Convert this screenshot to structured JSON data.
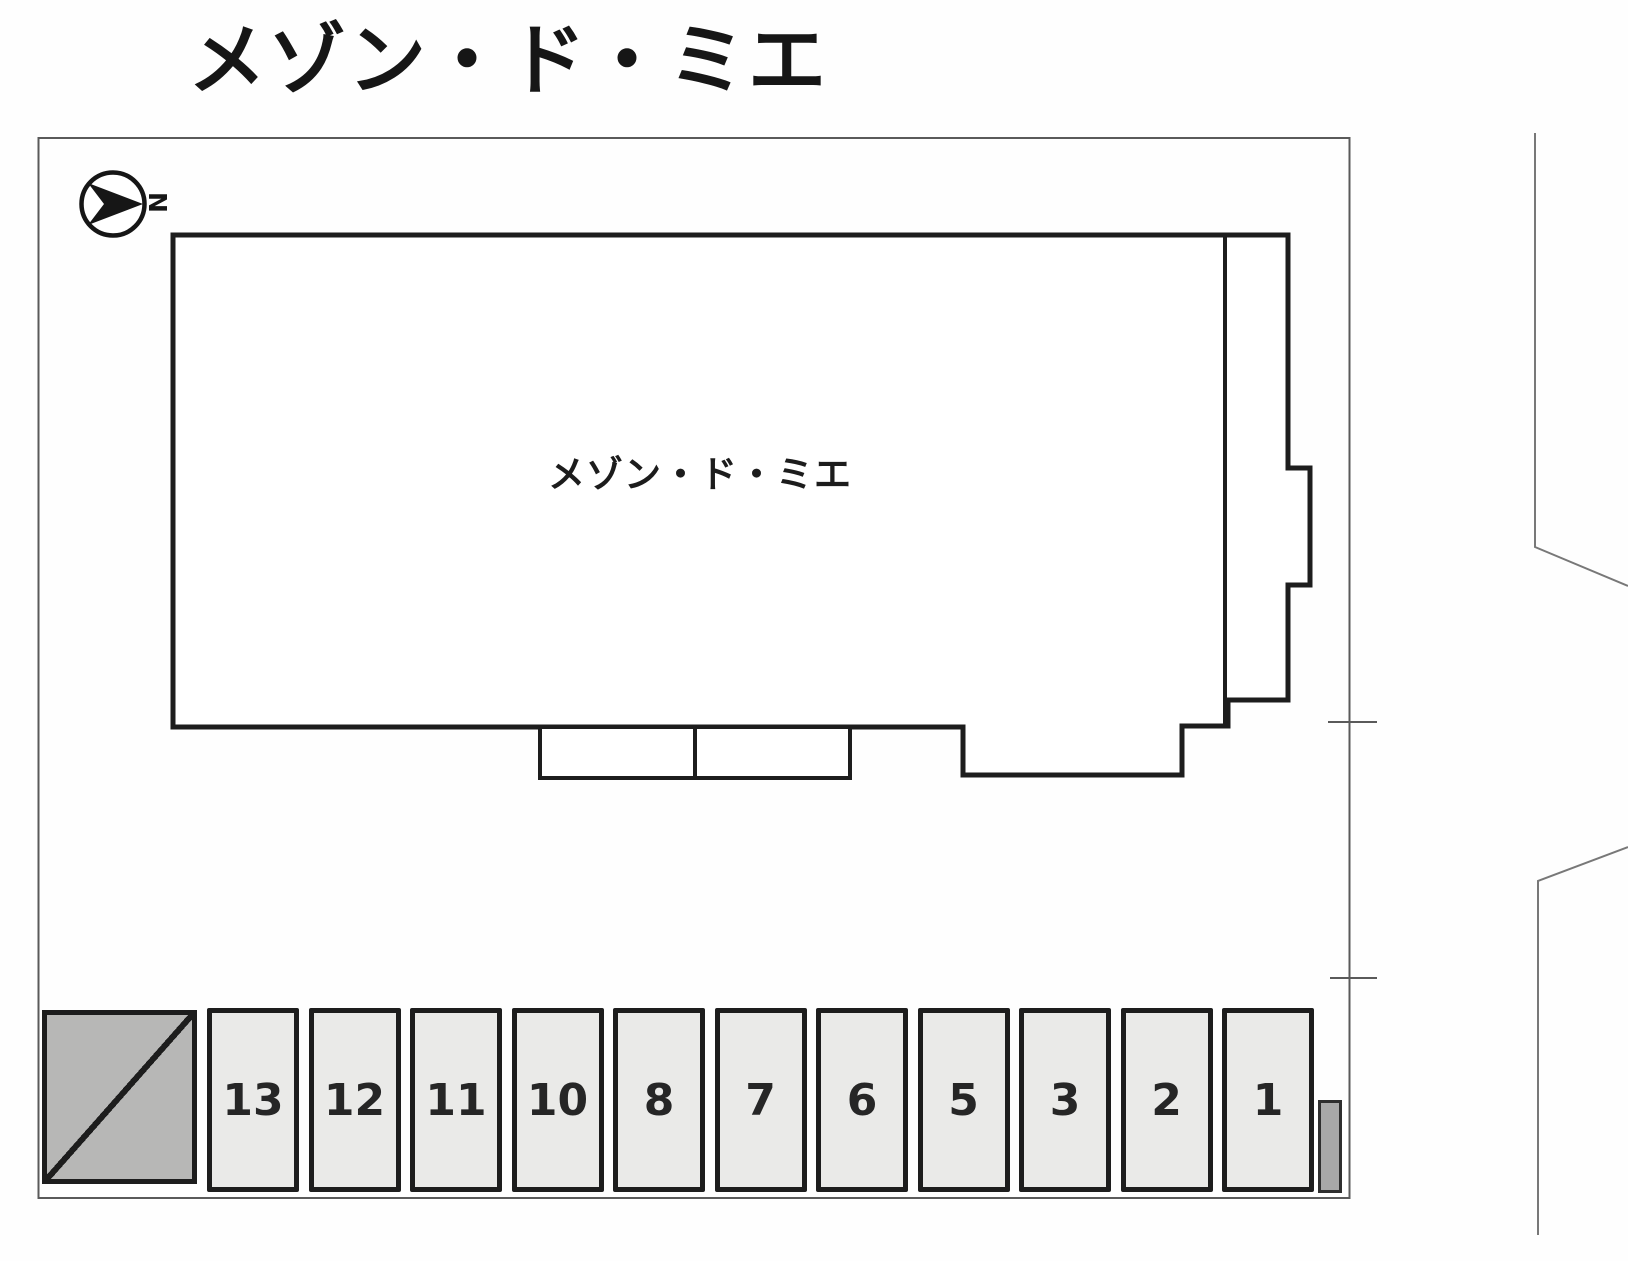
{
  "title": "メゾン・ド・ミエ",
  "compass": {
    "label": "N",
    "points": "right"
  },
  "building": {
    "label": "メゾン・ド・ミエ"
  },
  "parking": {
    "space_labels": [
      "13",
      "12",
      "11",
      "10",
      "8",
      "7",
      "6",
      "5",
      "3",
      "2",
      "1"
    ]
  },
  "colors": {
    "outline": "#1d1d1d",
    "parking_fill": "#eaeae8",
    "gray_fill": "#b7b7b6",
    "boundary_line": "#5a5a5a",
    "road_line": "#787878"
  }
}
